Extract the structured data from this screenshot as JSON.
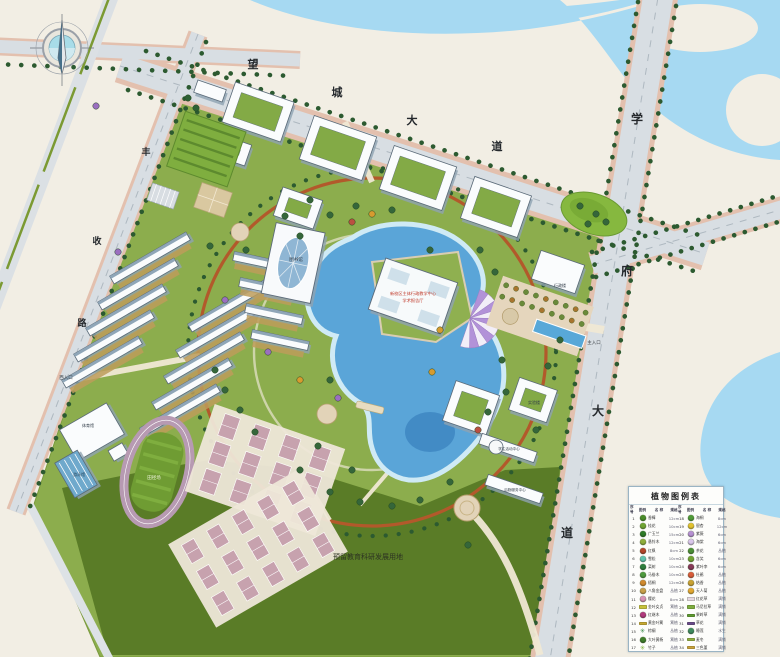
{
  "plan": {
    "reserved_land_note": "预留教育科研发展用地"
  },
  "road_labels": [
    {
      "text": "望",
      "x": 253,
      "y": 68,
      "size": 11
    },
    {
      "text": "城",
      "x": 337,
      "y": 96,
      "size": 11
    },
    {
      "text": "大",
      "x": 412,
      "y": 124,
      "size": 11
    },
    {
      "text": "道",
      "x": 497,
      "y": 150,
      "size": 11
    },
    {
      "text": "学",
      "x": 637,
      "y": 123,
      "size": 12
    },
    {
      "text": "府",
      "x": 627,
      "y": 275,
      "size": 12
    },
    {
      "text": "大",
      "x": 598,
      "y": 415,
      "size": 12
    },
    {
      "text": "道",
      "x": 567,
      "y": 537,
      "size": 12
    },
    {
      "text": "丰",
      "x": 146,
      "y": 155,
      "size": 9
    },
    {
      "text": "收",
      "x": 97,
      "y": 244,
      "size": 9
    },
    {
      "text": "路",
      "x": 82,
      "y": 326,
      "size": 9
    }
  ],
  "site_labels": [
    {
      "text": "预留教育科研发展用地",
      "x": 368,
      "y": 559,
      "size": 7,
      "color": "#2d3422"
    },
    {
      "text": "主入口",
      "x": 594,
      "y": 344,
      "size": 4.5,
      "color": "#3a3f44"
    },
    {
      "text": "西入口",
      "x": 66,
      "y": 379,
      "size": 4.5,
      "color": "#3a3f44"
    },
    {
      "text": "图书馆",
      "x": 296,
      "y": 261,
      "size": 4.5,
      "color": "#2f3a46"
    },
    {
      "text": "行政楼",
      "x": 560,
      "y": 287,
      "size": 4,
      "color": "#2f3a46"
    },
    {
      "text": "体育馆",
      "x": 88,
      "y": 427,
      "size": 4,
      "color": "#2f3a46"
    },
    {
      "text": "游泳馆",
      "x": 79,
      "y": 476,
      "size": 4,
      "color": "#24425a"
    },
    {
      "text": "田径场",
      "x": 154,
      "y": 479,
      "size": 4.5,
      "color": "#eef4da"
    },
    {
      "text": "实验楼",
      "x": 534,
      "y": 404,
      "size": 4,
      "color": "#2f3a46"
    },
    {
      "text": "学生活动中心",
      "x": 509,
      "y": 450,
      "size": 3.6,
      "color": "#2f3a46"
    },
    {
      "text": "后勤服务中心",
      "x": 515,
      "y": 491,
      "size": 3.6,
      "color": "#2f3a46"
    },
    {
      "text": "新校区主体行政教学中心",
      "x": 413,
      "y": 295,
      "size": 4.2,
      "color": "#c03a2a"
    },
    {
      "text": "学术报告厅",
      "x": 413,
      "y": 302,
      "size": 4.2,
      "color": "#c03a2a"
    }
  ],
  "legend": {
    "title": "植物图例表",
    "headers": [
      "序号",
      "图例",
      "名 称",
      "规格"
    ],
    "rows": [
      {
        "n1": "1",
        "name1": "香樟",
        "spec1": "12cm",
        "c1": "#4a8c2a",
        "s1": "circle",
        "n2": "18",
        "name2": "海桐",
        "spec2": "8cm",
        "c2": "#4f9a37",
        "s2": "circle"
      },
      {
        "n1": "2",
        "name1": "桂花",
        "spec1": "10cm",
        "c1": "#6fa433",
        "s1": "circle",
        "n2": "19",
        "name2": "银杏",
        "spec2": "12cm",
        "c2": "#e2c22f",
        "s2": "circle"
      },
      {
        "n1": "3",
        "name1": "广玉兰",
        "spec1": "15cm",
        "c1": "#2f7a28",
        "s1": "circle",
        "n2": "20",
        "name2": "紫薇",
        "spec2": "6cm",
        "c2": "#b691d2",
        "s2": "circle"
      },
      {
        "n1": "4",
        "name1": "悬铃木",
        "spec1": "12cm",
        "c1": "#8fae3a",
        "s1": "circle",
        "n2": "21",
        "name2": "海棠",
        "spec2": "6cm",
        "c2": "#d9c6ea",
        "s2": "circle"
      },
      {
        "n1": "5",
        "name1": "红枫",
        "spec1": "8cm",
        "c1": "#b4462a",
        "s1": "circle",
        "n2": "22",
        "name2": "茶花",
        "spec2": "丛植",
        "c2": "#4c8f36",
        "s2": "circle"
      },
      {
        "n1": "6",
        "name1": "雪松",
        "spec1": "10cm",
        "c1": "#62c4ae",
        "s1": "circle",
        "n2": "23",
        "name2": "含笑",
        "spec2": "6cm",
        "c2": "#72a433",
        "s2": "circle"
      },
      {
        "n1": "7",
        "name1": "栾树",
        "spec1": "10cm",
        "c1": "#2e7d3c",
        "s1": "circle",
        "n2": "24",
        "name2": "紫叶李",
        "spec2": "6cm",
        "c2": "#873a58",
        "s2": "circle"
      },
      {
        "n1": "8",
        "name1": "马褂木",
        "spec1": "10cm",
        "c1": "#4f9a3f",
        "s1": "circle",
        "n2": "25",
        "name2": "杜鹃",
        "spec2": "丛植",
        "c2": "#d85c3a",
        "s2": "circle"
      },
      {
        "n1": "9",
        "name1": "梧桐",
        "spec1": "12cm",
        "c1": "#d08a2e",
        "s1": "circle",
        "n2": "26",
        "name2": "结香",
        "spec2": "丛植",
        "c2": "#c9a233",
        "s2": "circle"
      },
      {
        "n1": "10",
        "name1": "八角金盘",
        "spec1": "丛植",
        "c1": "#c8a04a",
        "s1": "circle",
        "n2": "27",
        "name2": "天人菊",
        "spec2": "丛植",
        "c2": "#e2a832",
        "s2": "circle"
      },
      {
        "n1": "11",
        "name1": "樱花",
        "spec1": "8cm",
        "c1": "#d893b6",
        "s1": "circle",
        "n2": "28",
        "name2": "红花草",
        "spec2": "满铺",
        "c2": "#e6d9e2",
        "s2": "rect"
      },
      {
        "n1": "12",
        "name1": "金叶女贞",
        "spec1": "篱植",
        "c1": "#c6c13c",
        "s1": "rect",
        "n2": "29",
        "name2": "马尼拉草",
        "spec2": "满铺",
        "c2": "#7fae3f",
        "s2": "rect"
      },
      {
        "n1": "13",
        "name1": "红继木",
        "spec1": "丛植",
        "c1": "#b03a7c",
        "s1": "circle",
        "n2": "30",
        "name2": "果岭草",
        "spec2": "满铺",
        "c2": "#5e9a30",
        "s2": "rect"
      },
      {
        "n1": "14",
        "name1": "黄金叶篱",
        "spec1": "篱植",
        "c1": "#c7a832",
        "s1": "rect",
        "n2": "31",
        "name2": "草花",
        "spec2": "满铺",
        "c2": "#6a4a8c",
        "s2": "rect"
      },
      {
        "n1": "15",
        "name1": "棕榈",
        "spec1": "丛植",
        "c1": "#3c8a4c",
        "s1": "star",
        "n2": "32",
        "name2": "睡莲",
        "spec2": "水生",
        "c2": "#3f8a5e",
        "s2": "circle"
      },
      {
        "n1": "16",
        "name1": "大叶黄杨",
        "spec1": "篱植",
        "c1": "#3f7d2a",
        "s1": "circle",
        "n2": "33",
        "name2": "麦冬",
        "spec2": "满铺",
        "c2": "#8fae3f",
        "s2": "rect"
      },
      {
        "n1": "17",
        "name1": "竹子",
        "spec1": "丛植",
        "c1": "#82b43e",
        "s1": "star",
        "n2": "34",
        "name2": "三色堇",
        "spec2": "满铺",
        "c2": "#caa23a",
        "s2": "rect"
      }
    ]
  },
  "colors": {
    "background": "#f2eee4",
    "water": "#a6d9f2",
    "lake": "#5aa5d8",
    "campus_green": "#8cad4d",
    "reserved_green": "#5a7c27",
    "ring_road": "#b2592b",
    "road_asphalt": "#d8dee3",
    "sidewalk_pink": "#e3c0ae"
  }
}
